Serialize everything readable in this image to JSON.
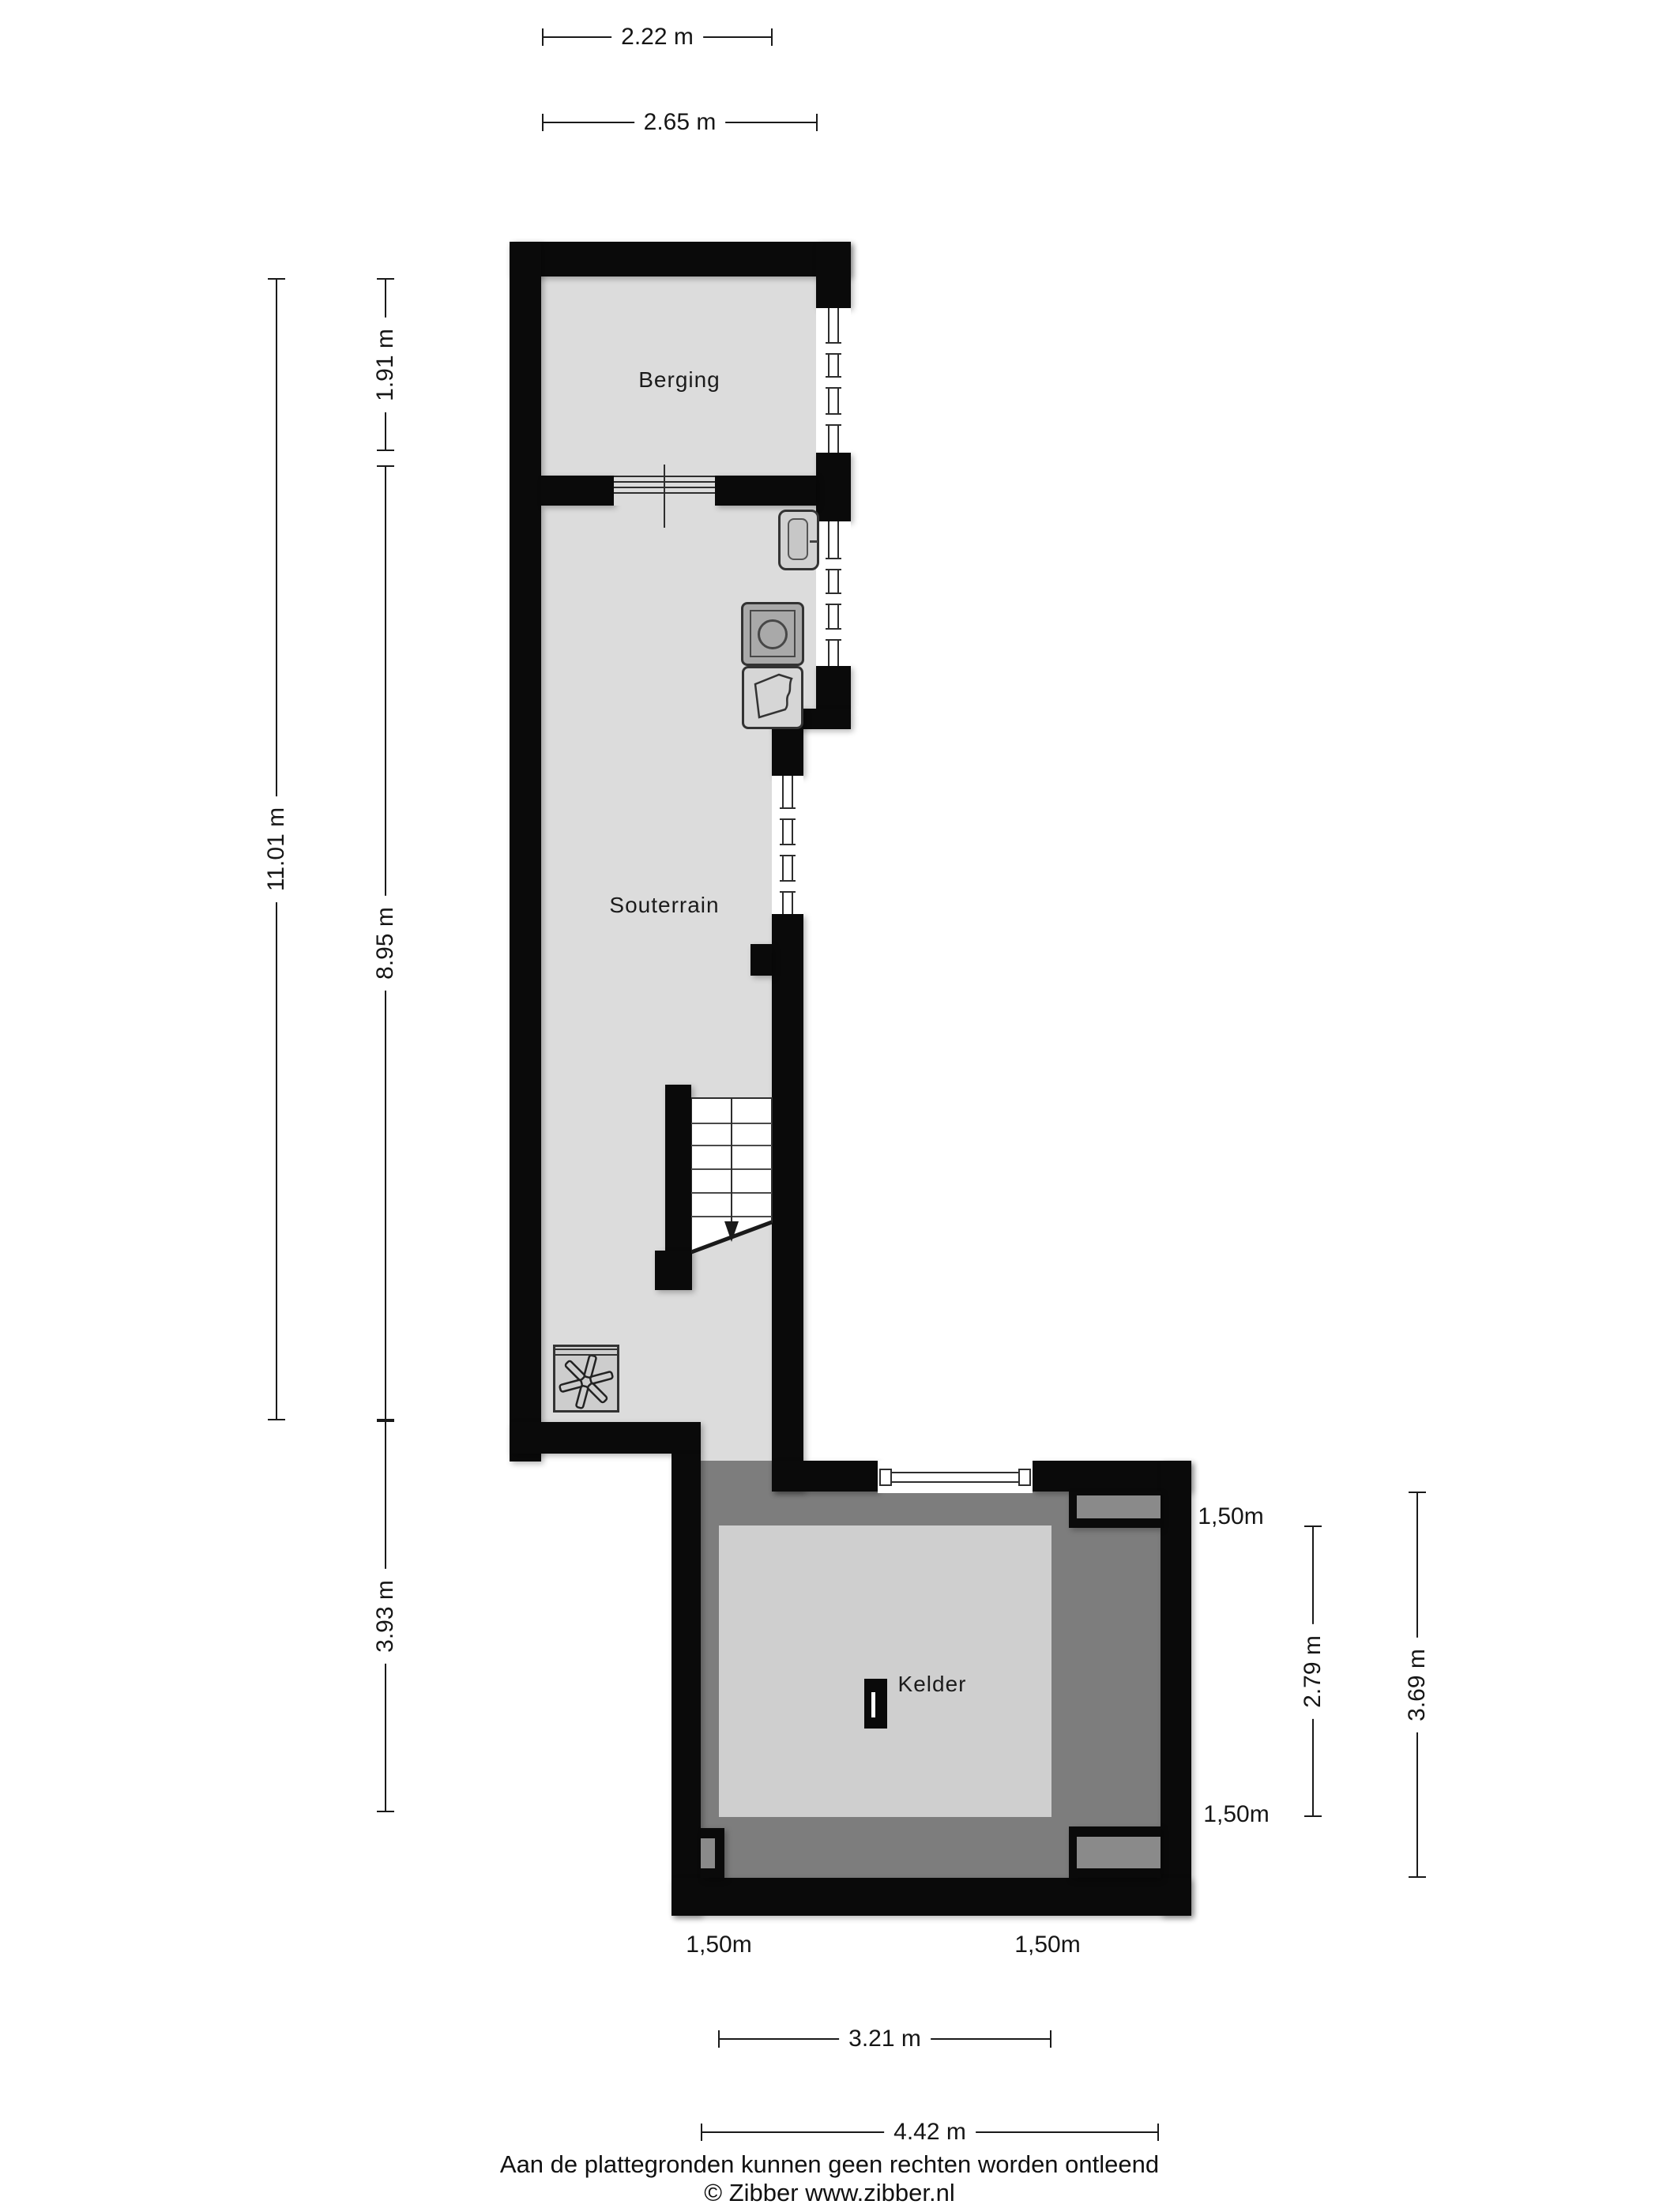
{
  "rooms": {
    "berging": "Berging",
    "souterrain": "Souterrain",
    "kelder": "Kelder"
  },
  "dimensions": {
    "top_width_inner": "2.22 m",
    "top_width_outer": "2.65 m",
    "left_berging_height": "1.91 m",
    "left_total_height": "11.01 m",
    "left_souterrain_height": "8.95 m",
    "left_kelder_height": "3.93 m",
    "right_kelder_inner_height": "2.79 m",
    "right_kelder_total_height": "3.69 m",
    "bottom_inner_width": "3.21 m",
    "bottom_total_width": "4.42 m",
    "headroom_top_right": "1,50m",
    "headroom_mid_right": "1,50m",
    "headroom_bottom_left": "1,50m",
    "headroom_bottom_right": "1,50m"
  },
  "footer": {
    "disclaimer": "Aan de plattegronden kunnen geen rechten worden ontleend",
    "copyright": "© Zibber www.zibber.nl"
  },
  "icons": {
    "fan": "ventilation fan (asterisk blades in square)",
    "stairs": "staircase with down arrow",
    "window": "double-line glazing symbol",
    "sliding_door": "stacked horizontal lines",
    "washing_machine": "square with drum circle",
    "sink": "rounded basin",
    "laundry_tub": "basin with wavy rim",
    "kelder_hatch": "black rectangle with white slit"
  },
  "colors": {
    "wall": "#0a0a0a",
    "floor": "#dcdcdc",
    "floor-dark": "#7d7d7d",
    "kelder-floor": "#cfcfcf",
    "niche": "#8a8a8a",
    "appliance": "#a9a9a9",
    "line": "#1a1a1a"
  }
}
